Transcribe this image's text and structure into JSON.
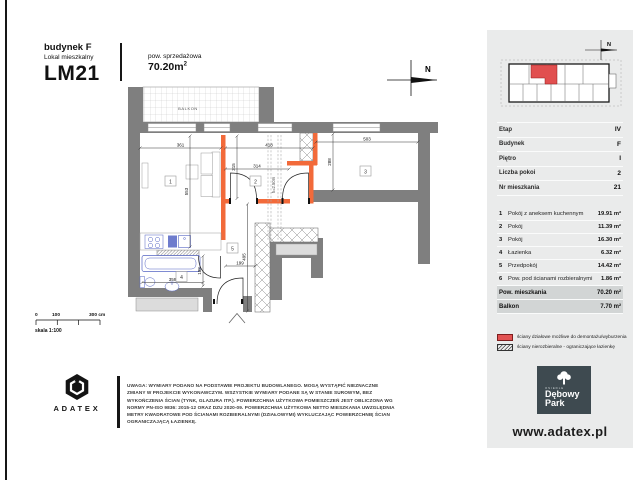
{
  "page": {
    "header": {
      "building": "budynek F",
      "unit_type": "Lokal mieszkalny",
      "unit_code": "LM21",
      "area_label": "pow. sprzedażowa",
      "area_value": "70.20m",
      "area_unit_sup": "2"
    },
    "scale_bar": {
      "tick0": "0",
      "tick100": "100",
      "tick300": "300 cm",
      "scale_label": "skala 1:100"
    },
    "footer": {
      "brand": "ADATEX",
      "disclaimer": "UWAGA: WYMIARY PODANO NA PODSTAWIE PROJEKTU BUDOWLANEGO. MOGĄ WYSTĄPIĆ NIEZNACZNE ZMIANY W PROJEKCIE WYKONAWCZYM. WSZYSTKIE WYMIARY PODANE SĄ W STANIE SUROWYM, BEZ WYKOŃCZENIA ŚCIAN (TYNK, GLAZURA ITP.). POWIERZCHNIA UŻYTKOWA POMIESZCZEŃ JEST OBLICZONA WG NORMY PN-ISO 9836: 2015-12 ORAZ DZU 2020-09. POWIERZCHNIA UŻYTKOWA NETTO MIESZKANIA UWZGLĘDNIA METRY KWADRATOWE POD ŚCIANAMI ROZBIERALNYMI (DZIAŁOWYMI) WYKLUCZAJĄC POWIERZCHNIĘ ŚCIAN OGRANICZAJĄCĄ ŁAZIENKĘ."
    }
  },
  "plan": {
    "balcony_label": "BALKON",
    "height_note": "h=2.50m",
    "north_label": "N",
    "room_numbers": {
      "r1": "1",
      "r2": "2",
      "r3": "3",
      "r4": "4",
      "r5": "5"
    },
    "dims": {
      "d361": "361",
      "d418": "418",
      "d503": "503",
      "d553": "553",
      "d315": "315",
      "d314": "314",
      "d288": "288",
      "d495": "495",
      "d199": "199",
      "d188": "188",
      "d359": "359"
    }
  },
  "sidebar": {
    "info_rows": [
      {
        "label": "Etap",
        "value": "IV"
      },
      {
        "label": "Budynek",
        "value": "F"
      },
      {
        "label": "Piętro",
        "value": "I"
      },
      {
        "label": "Liczba pokoi",
        "value": "2"
      },
      {
        "label": "Nr mieszkania",
        "value": "21"
      }
    ],
    "room_rows": [
      {
        "no": "1",
        "name": "Pokój z aneksem kuchennym",
        "area": "19.91 m²"
      },
      {
        "no": "2",
        "name": "Pokój",
        "area": "11.39 m²"
      },
      {
        "no": "3",
        "name": "Pokój",
        "area": "16.30 m²"
      },
      {
        "no": "4",
        "name": "Łazienka",
        "area": "6.32 m²"
      },
      {
        "no": "5",
        "name": "Przedpokój",
        "area": "14.42 m²"
      },
      {
        "no": "6",
        "name": "Pow. pod ścianami rozbieralnymi",
        "area": "1.86 m²"
      }
    ],
    "summary_rows": [
      {
        "label": "Pow. mieszkania",
        "area": "70.20 m²"
      },
      {
        "label": "Balkon",
        "area": "7.70 m²"
      }
    ],
    "legend": [
      {
        "text": "ściany działowe możliwe do demontażu/wyburzenia"
      },
      {
        "text": "ściany nierozbieralne - ograniczające łazienkę"
      }
    ],
    "park_logo": {
      "osiedle": "OSIEDLE",
      "name1": "Dębowy",
      "name2": "Park"
    },
    "website": "www.adatex.pl"
  },
  "colors": {
    "wall_gray": "#7f7f7f",
    "demolishable_orange": "#f26a3a",
    "highlight_red": "#e14f4f",
    "panel_gray": "#eaebeb",
    "fixture_blue": "#5565c4"
  }
}
